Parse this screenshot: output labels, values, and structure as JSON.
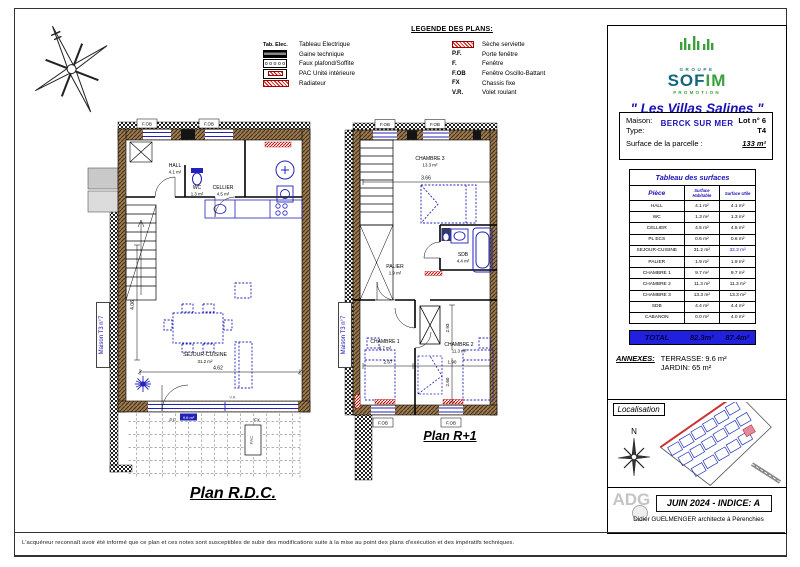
{
  "sheet": {
    "disclaimer": "L'acquéreur reconnaît avoir été informé que ce plan et ces notes sont susceptibles de subir des modifications suite à la mise au point des plans d'exécution et des impératifs techniques."
  },
  "colors": {
    "brand_blue": "#1a12b5",
    "sofim_teal": "#16657e",
    "sofim_green": "#3aa13a",
    "plan_blue": "#2222bb",
    "wall_brown": "#9c7b50",
    "radiator_red": "#cc0000",
    "total_bg": "#2020dd"
  },
  "legend": {
    "title": "LEGENDE DES PLANS:",
    "left": [
      {
        "code": "Tab. Elec.",
        "label": "Tableau Electrique"
      },
      {
        "code": "",
        "label": "Gaine technique"
      },
      {
        "code": "",
        "label": "Faux plafond/Soffite"
      },
      {
        "code": "",
        "label": "PAC Unité intérieure"
      },
      {
        "code": "",
        "label": "Radiateur"
      }
    ],
    "right": [
      {
        "code": "",
        "label": "Sèche serviette"
      },
      {
        "code": "P.F.",
        "label": "Porte fenêtre"
      },
      {
        "code": "F.",
        "label": "Fenêtre"
      },
      {
        "code": "F.OB",
        "label": "Fenêtre Oscillo-Battant"
      },
      {
        "code": "FX",
        "label": "Chassis fixe"
      },
      {
        "code": "V.R.",
        "label": "Volet roulant"
      }
    ]
  },
  "brand": {
    "groupe": "GROUPE",
    "name_a": "SOF",
    "name_b": "IM",
    "promotion": "PROMOTION",
    "title": "\" Les Villas Salines \"",
    "city": "BERCK SUR MER"
  },
  "project": {
    "maison_label": "Maison:",
    "maison_value": "Lot n° 6",
    "type_label": "Type:",
    "type_value": "T4",
    "parcelle_label": "Surface de la parcelle :",
    "parcelle_value": "133 m²"
  },
  "surfaces": {
    "title": "Tableau des surfaces",
    "col_piece": "Pièce",
    "col_hab": "Surface Habitable",
    "col_utile": "Surface Utile",
    "rows": [
      {
        "piece": "HALL",
        "hab": "4.1 m²",
        "utile": "4.1 m²"
      },
      {
        "piece": "WC",
        "hab": "1.3 m²",
        "utile": "1.3 m²"
      },
      {
        "piece": "CELLIER",
        "hab": "4.5 m²",
        "utile": "4.5 m²"
      },
      {
        "piece": "PL ECS",
        "hab": "0.6 m²",
        "utile": "0.6 m²"
      },
      {
        "piece": "SEJOUR-CUISINE",
        "hab": "31.2 m²",
        "utile": "32.3 m²"
      },
      {
        "piece": "PALIER",
        "hab": "1.9 m²",
        "utile": "1.9 m²"
      },
      {
        "piece": "CHAMBRE 1",
        "hab": "9.7 m²",
        "utile": "9.7 m²"
      },
      {
        "piece": "CHAMBRE 2",
        "hab": "11.3 m²",
        "utile": "11.3 m²"
      },
      {
        "piece": "CHAMBRE 3",
        "hab": "13.3 m²",
        "utile": "13.3 m²"
      },
      {
        "piece": "SDB",
        "hab": "4.4 m²",
        "utile": "4.4 m²"
      },
      {
        "piece": "CABANON",
        "hab": "0.0 m²",
        "utile": "4.0 m²"
      }
    ],
    "total_label": "TOTAL",
    "total_hab": "82.3m²",
    "total_utile": "87.4m²",
    "annexes_label": "ANNEXES:",
    "terrasse": "TERRASSE: 9.6 m²",
    "jardin": "JARDIN: 65 m²"
  },
  "localisation": {
    "title": "Localisation",
    "north": "N"
  },
  "titleblock": {
    "logo": "ADG",
    "date_indice": "JUIN 2024 - INDICE: A",
    "architect": "Didier GUELMENGER architecte à Pérenchies"
  },
  "plans": {
    "labels": {
      "fob": "F.OB",
      "vr": "V.R.",
      "pf": "P.F.",
      "fx": "FX",
      "pac": "PAC"
    },
    "rdc": {
      "title": "Plan R.D.C.",
      "neighbor": "Maison T3 n°7",
      "rooms": [
        {
          "name": "HALL",
          "area": "4.1 m²"
        },
        {
          "name": "WC",
          "area": "1.3 m²"
        },
        {
          "name": "CELLIER",
          "area": "4.5 m²"
        },
        {
          "name": "SEJOUR-CUISINE",
          "area": "31.2 m²"
        }
      ],
      "dims": {
        "w": "4.62",
        "h": "4.06"
      },
      "terrace_tag": "9.6 m²"
    },
    "r1": {
      "title": "Plan R+1",
      "neighbor": "Maison T3 n°7",
      "rooms": [
        {
          "name": "CHAMBRE 3",
          "area": "13.3 m²"
        },
        {
          "name": "PALIER",
          "area": "1.9 m²"
        },
        {
          "name": "SDB",
          "area": "4.4 m²"
        },
        {
          "name": "CHAMBRE 1",
          "area": "9.7 m²"
        },
        {
          "name": "CHAMBRE 2",
          "area": "11.3 m²"
        }
      ],
      "dims": {
        "w": "3.66",
        "w1": "2.67",
        "w2": "1.90",
        "h1": "2.93",
        "h2": "2.60"
      }
    }
  }
}
